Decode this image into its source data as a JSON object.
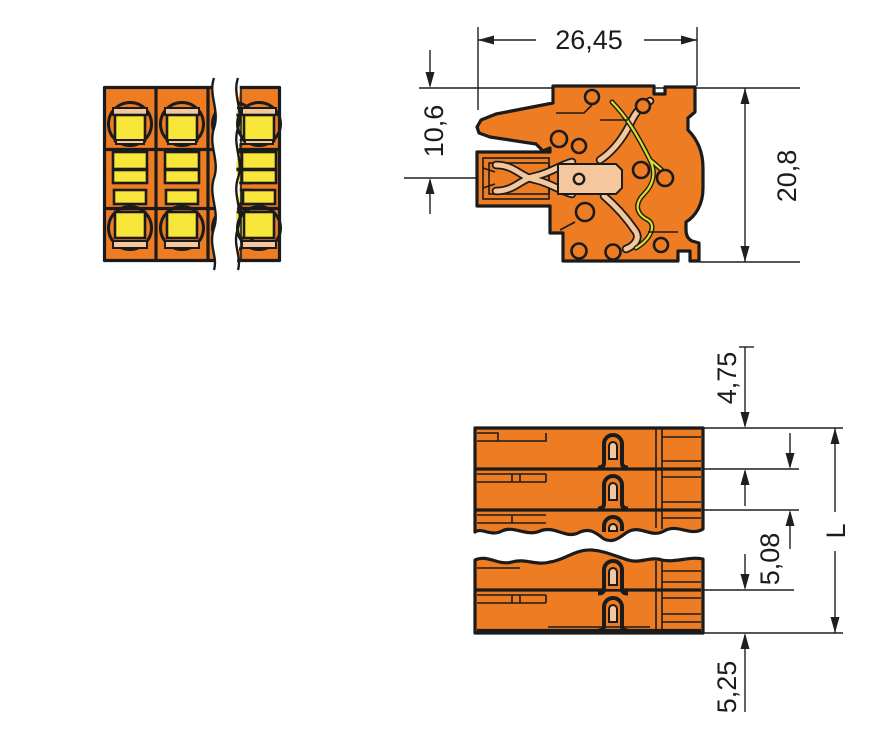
{
  "drawing": {
    "title": "terminal-block-dimension-drawing",
    "dimensions": {
      "overall_depth": "26,45",
      "upper_height": "10,6",
      "total_height": "20,8",
      "end_offset_top": "4,75",
      "pole_pitch": "5,08",
      "total_length": "L",
      "end_offset_bottom": "5,25"
    },
    "colors": {
      "body_orange": "#EE7C23",
      "window_yellow": "#F9E63A",
      "contact_copper": "#F4C79C",
      "spring_yellow": "#DCDF2B",
      "outline_ink": "#1B1B1B",
      "background": "#FFFFFF"
    }
  }
}
